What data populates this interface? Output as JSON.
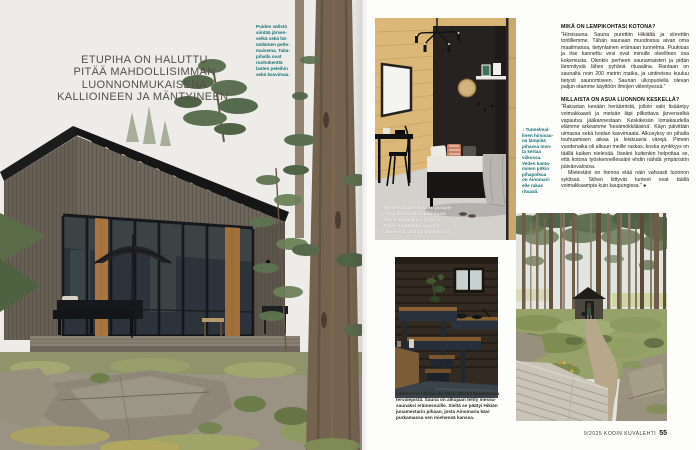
{
  "magazine": {
    "left_page": {
      "headline": "ETUPIHA ON HALUTTU\nPITÄÄ MAHDOLLISIMMAN\nLUONNONMUKAISENA\nKALLIOINEEN JA MÄNTYINEEN.",
      "photo_caption": "Puiden välistä\nsiintää järven-\nselkä sekä hä-\nmäläinen pelto-\nmaisema. Taka-\npihalla ovat\nruohokenttä\nlasten peleihin\nsekä kasvimaa.",
      "photo_alt": "dark timber cabin on mossy rocks among pines"
    },
    "right_page": {
      "interior_caption": "Tyttöjen huoneessa on puupin-\nnat ja kontrastiksi pikimusta\nseinä. Raidallinen tyyny on\nAlpon muutaman vuoden\ntakaisesta sisustusmallistosta.",
      "sauna_pointer_caption": "↓ Tunnelmal-\nlinen hirsisau-\nna lämpiää\npihassa mon-\nta kertaa\nviikossa.\nVeden kanta-\nminen pitkin\npihapolkua\non Ainomari-\nelle rakas\nrituaali.",
      "qa": [
        {
          "question": "MIKÄ ON LEMPIKOHTASI KOTONA?",
          "answer": "”Hirsisauna. Sauna purettiin Hikiältä ja siirrettiin tontillemme. Tähän saunaan muodostuu aivan oma maailmansa, tietynlainen erämaan tunnelma. Puukiuas ja itse kannettu vesi ovat minulle oleellinen osa kokemusta. Olenkin perheen saunamaisteri ja pidän lämmitystä lähes pyhänä rituaalina. Rantaan on saunalta noin 200 metrin matka, ja uintireissu kuuluu tietysti saunomiseen. Saunan ulkopuolella olevan paljun otamme käyttöön ilmojen viilentyessä.”"
        },
        {
          "question": "MILLAISTA ON ASUA LUONNON KESKELLÄ?",
          "answer": "”Rakastan kevään heräämistä, jolloin valo lisääntyy voimakkaasti ja metsän läpi pilkottava järvenselkä vapautuu jääkannestaan. Keskikesän lomakaudella elämme arkeamme ’kesämökkiläisinä’. Käyn päivittäin uimassa sekä hoidan kasvimaata. Alkusyksy on pihalla touhuamisen aikaa ja leiskuavia värejä. Pimein vuodenaika oli alkuun meille raskas, koska synkkyys on täällä kaiken nielevää. Itseäni kuitenkin helpottaa se, että kotona työskennellessäni ehdin nähdä ympäristön päivänvalossa.",
          "answer2": "Mielestäni on hienoa elää näin vahvasti luonnon syklissä. Siihen liittyvät tunteet ovat täällä voimakkaampia kuin kaupungissa.” ●"
        }
      ],
      "sauna_caption": "Lauteet on nikkaroitu talon läheltä kaadetuista\ntervalepistä. Sauna on alkujaan tehty messu-\nsaunaksi erämessuille. Sieltä se päätyi Hikiän\njunamestarin pihaan, josta Ainomaria kävi\npurkamassa sen miehensä kanssa.",
      "footer": {
        "issue": "9/2025 KODIN KUVALEHTI",
        "page_number": "55"
      }
    },
    "colors": {
      "teal_caption": "#177075",
      "headline_gray": "#544f48",
      "body_text": "#26231f"
    }
  }
}
